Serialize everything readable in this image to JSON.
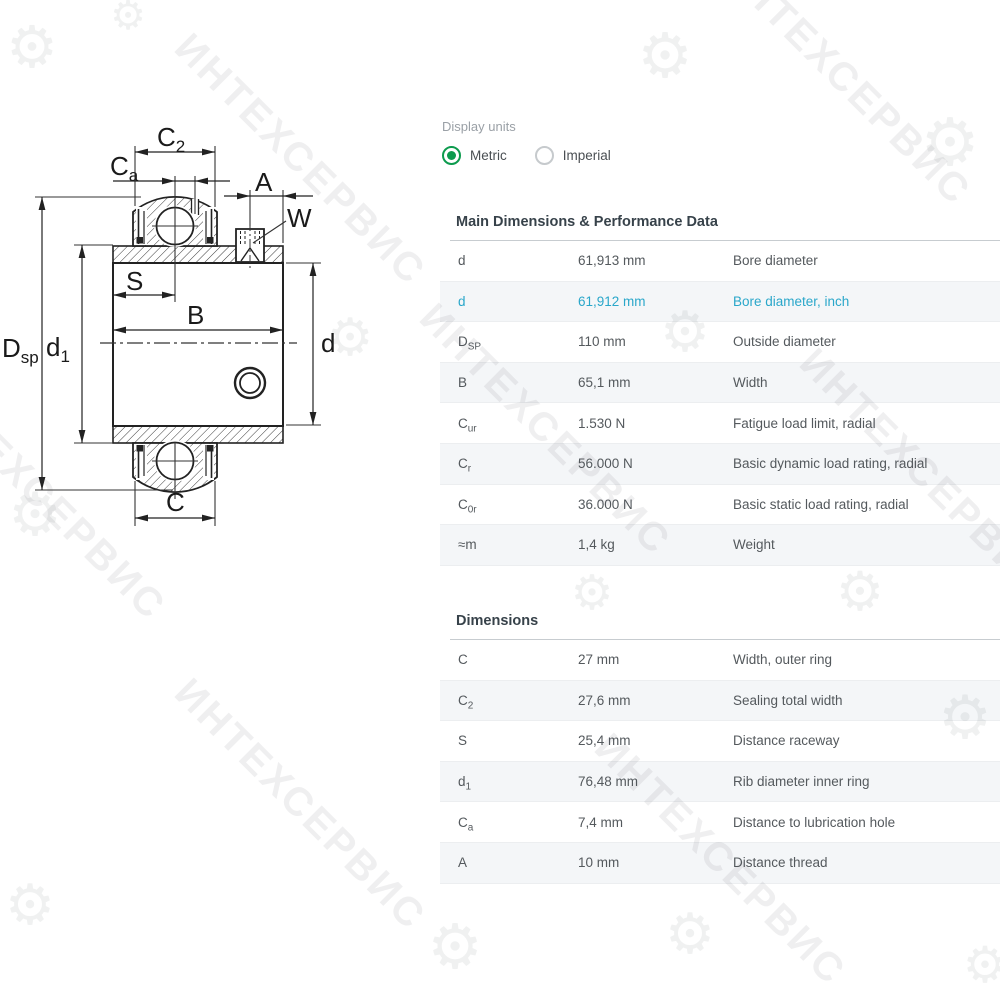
{
  "display_units": {
    "label": "Display units",
    "options": [
      {
        "label": "Metric",
        "selected": true
      },
      {
        "label": "Imperial",
        "selected": false
      }
    ]
  },
  "main_table": {
    "title": "Main Dimensions & Performance Data",
    "rows": [
      {
        "sym": "d",
        "sub": "",
        "value": "61,913 mm",
        "desc": "Bore diameter",
        "accent": false
      },
      {
        "sym": "d",
        "sub": "",
        "value": "61,912 mm",
        "desc": "Bore diameter, inch",
        "accent": true
      },
      {
        "sym": "D",
        "sub": "SP",
        "value": "110 mm",
        "desc": "Outside diameter",
        "accent": false
      },
      {
        "sym": "B",
        "sub": "",
        "value": "65,1 mm",
        "desc": "Width",
        "accent": false
      },
      {
        "sym": "C",
        "sub": "ur",
        "value": "1.530 N",
        "desc": "Fatigue load limit, radial",
        "accent": false
      },
      {
        "sym": "C",
        "sub": "r",
        "value": "56.000 N",
        "desc": "Basic dynamic load rating, radial",
        "accent": false
      },
      {
        "sym": "C",
        "sub": "0r",
        "value": "36.000 N",
        "desc": "Basic static load rating, radial",
        "accent": false
      },
      {
        "sym": "≈m",
        "sub": "",
        "value": "1,4 kg",
        "desc": "Weight",
        "accent": false
      }
    ]
  },
  "dimensions_table": {
    "title": "Dimensions",
    "rows": [
      {
        "sym": "C",
        "sub": "",
        "value": "27 mm",
        "desc": "Width, outer ring",
        "accent": false
      },
      {
        "sym": "C",
        "sub": "2",
        "value": "27,6 mm",
        "desc": "Sealing total width",
        "accent": false
      },
      {
        "sym": "S",
        "sub": "",
        "value": "25,4 mm",
        "desc": "Distance raceway",
        "accent": false
      },
      {
        "sym": "d",
        "sub": "1",
        "value": "76,48 mm",
        "desc": "Rib diameter inner ring",
        "accent": false
      },
      {
        "sym": "C",
        "sub": "a",
        "value": "7,4 mm",
        "desc": "Distance to lubrication hole",
        "accent": false
      },
      {
        "sym": "A",
        "sub": "",
        "value": "10 mm",
        "desc": "Distance thread",
        "accent": false
      }
    ]
  },
  "drawing": {
    "labels": {
      "c2": {
        "base": "C",
        "sub": "2"
      },
      "ca": {
        "base": "C",
        "sub": "a"
      },
      "a": {
        "base": "A",
        "sub": ""
      },
      "w": {
        "base": "W",
        "sub": ""
      },
      "s": {
        "base": "S",
        "sub": ""
      },
      "b": {
        "base": "B",
        "sub": ""
      },
      "c": {
        "base": "C",
        "sub": ""
      },
      "d": {
        "base": "d",
        "sub": ""
      },
      "d1": {
        "base": "d",
        "sub": "1"
      },
      "dsp": {
        "base": "D",
        "sub": "sp"
      }
    }
  },
  "watermark": {
    "text": "ИНТЕХСЕРВИС",
    "gear_glyph": "⚙"
  },
  "colors": {
    "accent_blue": "#2aa7ca",
    "radio_green": "#0d9b4e",
    "row_alt": "#f4f6f8",
    "header_text": "#37424a",
    "body_text": "#54595d",
    "muted_text": "#9aa0a6",
    "line_dark": "#222222"
  }
}
